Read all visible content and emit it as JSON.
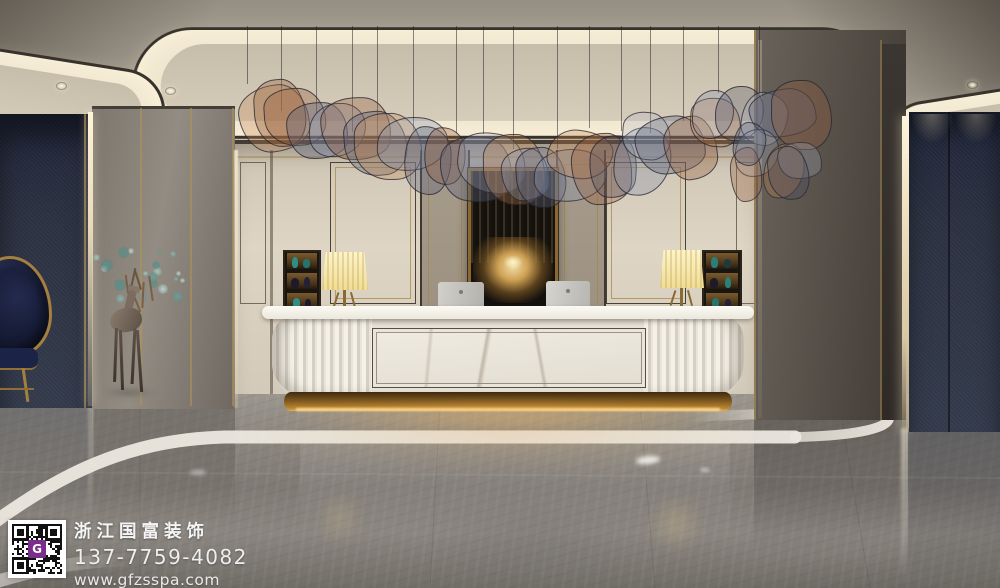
{
  "watermark": {
    "company_name": "浙江国富装饰",
    "phone": "137-7759-4082",
    "website": "www.gfzsspa.com",
    "qr_center_letter": "G"
  },
  "palette": {
    "qr_accent": "#7b2d8b",
    "gold_accent": "#b98a3c",
    "navy_wall": "#2a3040",
    "cream_wall": "#d9d0c0",
    "marble_floor": "#8a8782",
    "desk_white": "#f2efe7",
    "under_desk_glow": "#e8a84e",
    "lamp_shade": "#f5e7ae",
    "art_gold": "#d8b35c"
  }
}
